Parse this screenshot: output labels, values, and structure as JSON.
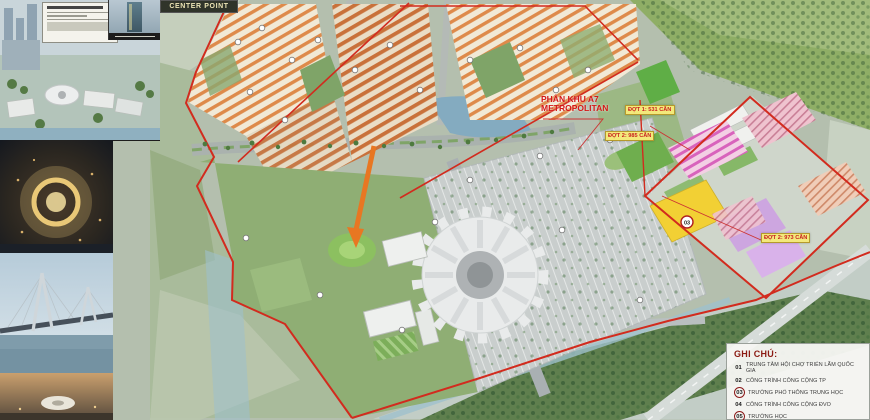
{
  "map": {
    "center_point": "CENTER POINT",
    "zone_label": {
      "line1": "PHÂN KHU A7",
      "line2": "METROPOLITAN"
    },
    "phase_chips": {
      "c1": "ĐỢT 1: 531 CĂN",
      "c2": "ĐỢT 2: 985 CĂN",
      "c3": "ĐỢT 2: 973 CĂN"
    },
    "plot_marker": "03"
  },
  "legend": {
    "title": "GHI CHÚ:",
    "items": [
      {
        "num": "01",
        "label": "TRUNG TÂM HỘI CHỢ TRIỂN LÃM QUỐC GIA",
        "circled": false
      },
      {
        "num": "02",
        "label": "CÔNG TRÌNH CÔNG CỘNG TP",
        "circled": false
      },
      {
        "num": "03",
        "label": "TRƯỜNG PHỔ THÔNG TRUNG HỌC",
        "circled": true
      },
      {
        "num": "04",
        "label": "CÔNG TRÌNH CÔNG CỘNG ĐVO",
        "circled": false
      },
      {
        "num": "05",
        "label": "TRƯỜNG HỌC",
        "circled": true
      }
    ]
  },
  "colors": {
    "boundary_red": "#d22b1e",
    "arrow_orange": "#e87722",
    "chip_bg": "#f3e97b",
    "chip_text": "#c81f1f",
    "legend_title": "#8b1a12",
    "lake_blue": "#7da6bc",
    "plot_yellow": "#f2d034",
    "plot_lavender": "#cda6e0",
    "plot_magenta": "#d863bc"
  }
}
